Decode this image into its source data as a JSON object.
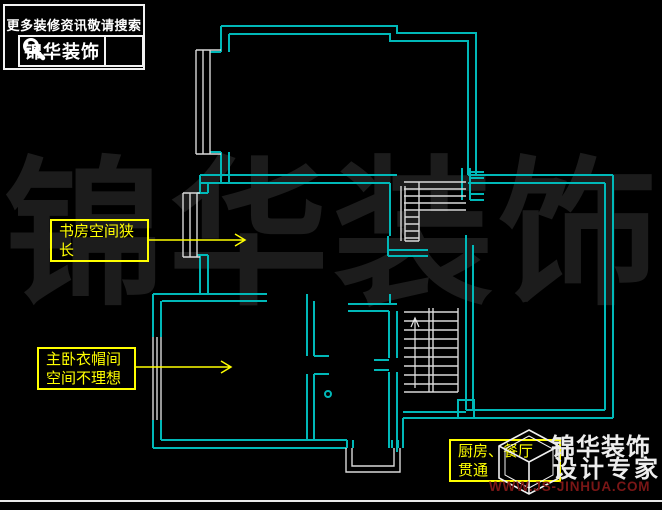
{
  "search_banner": {
    "tagline": "更多装修资讯敬请搜索",
    "brand": "锦华装饰",
    "icon": "magnifier-icon"
  },
  "watermark": {
    "full_text": "锦华装饰",
    "char1": "锦",
    "char2": "华",
    "char3": "装",
    "char4": "饰"
  },
  "annotations": {
    "study": {
      "line1": "书房空间狭",
      "line2": "长",
      "full": "书房空间狭长"
    },
    "wardrobe": {
      "line1": "主卧衣帽间",
      "line2": "空间不理想",
      "full": "主卧衣帽间空间不理想"
    },
    "kitchen": {
      "line1": "厨房、餐厅",
      "line2": "贯通",
      "full": "厨房、餐厅贯通"
    }
  },
  "brand_footer": {
    "name": "锦华装饰",
    "slogan": "设计专家",
    "url": "WWW.JS-JINHUA.COM",
    "logo": "jinhua-cube-logo"
  },
  "colors": {
    "background": "#000000",
    "wall_cyan": "#00b8b8",
    "detail_white": "#d9d9d9",
    "annotation_yellow": "#ffff00",
    "watermark_gray": "#1c1c1c",
    "brand_white": "#ededed",
    "url_red": "#7a1616"
  }
}
